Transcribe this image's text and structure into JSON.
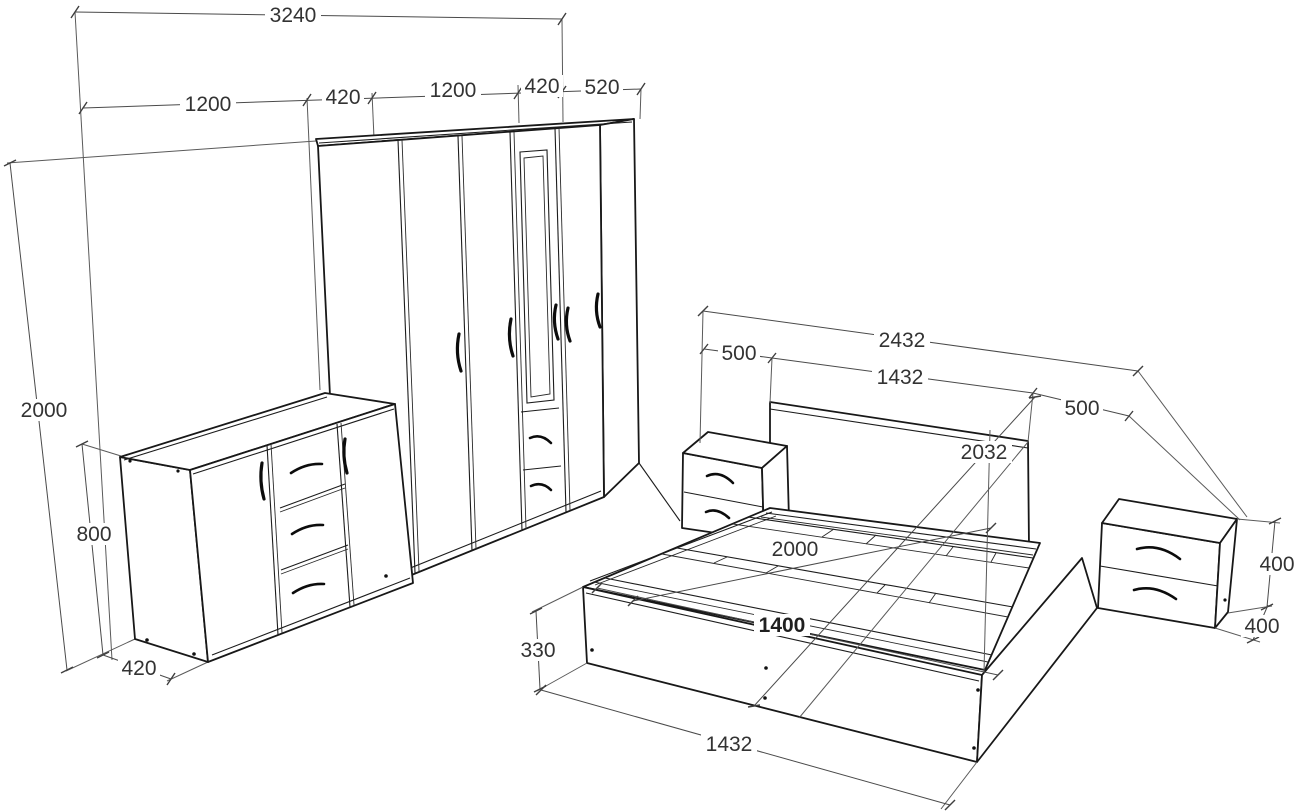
{
  "drawing": {
    "kind": "furniture-set-technical-drawing",
    "units": "mm",
    "pieces": [
      "wardrobe",
      "dresser",
      "bed",
      "left-nightstand",
      "right-nightstand"
    ]
  },
  "labels": {
    "wall_total": "3240",
    "wall_seg1": "1200",
    "wall_seg2": "420",
    "wall_seg3": "1200",
    "wall_seg4": "420",
    "wall_seg5": "520",
    "wardrobe_height": "2000",
    "dresser_height": "800",
    "dresser_depth": "420",
    "bed_total_width": "2432",
    "nightstand_left_width": "500",
    "headboard_width": "1432",
    "nightstand_right_width": "500",
    "bed_diagonal": "2032",
    "bed_length": "2000",
    "mattress_width": "1400",
    "bed_frame_height": "330",
    "bed_front_width": "1432",
    "nightstand_height": "400",
    "nightstand_depth": "400"
  }
}
